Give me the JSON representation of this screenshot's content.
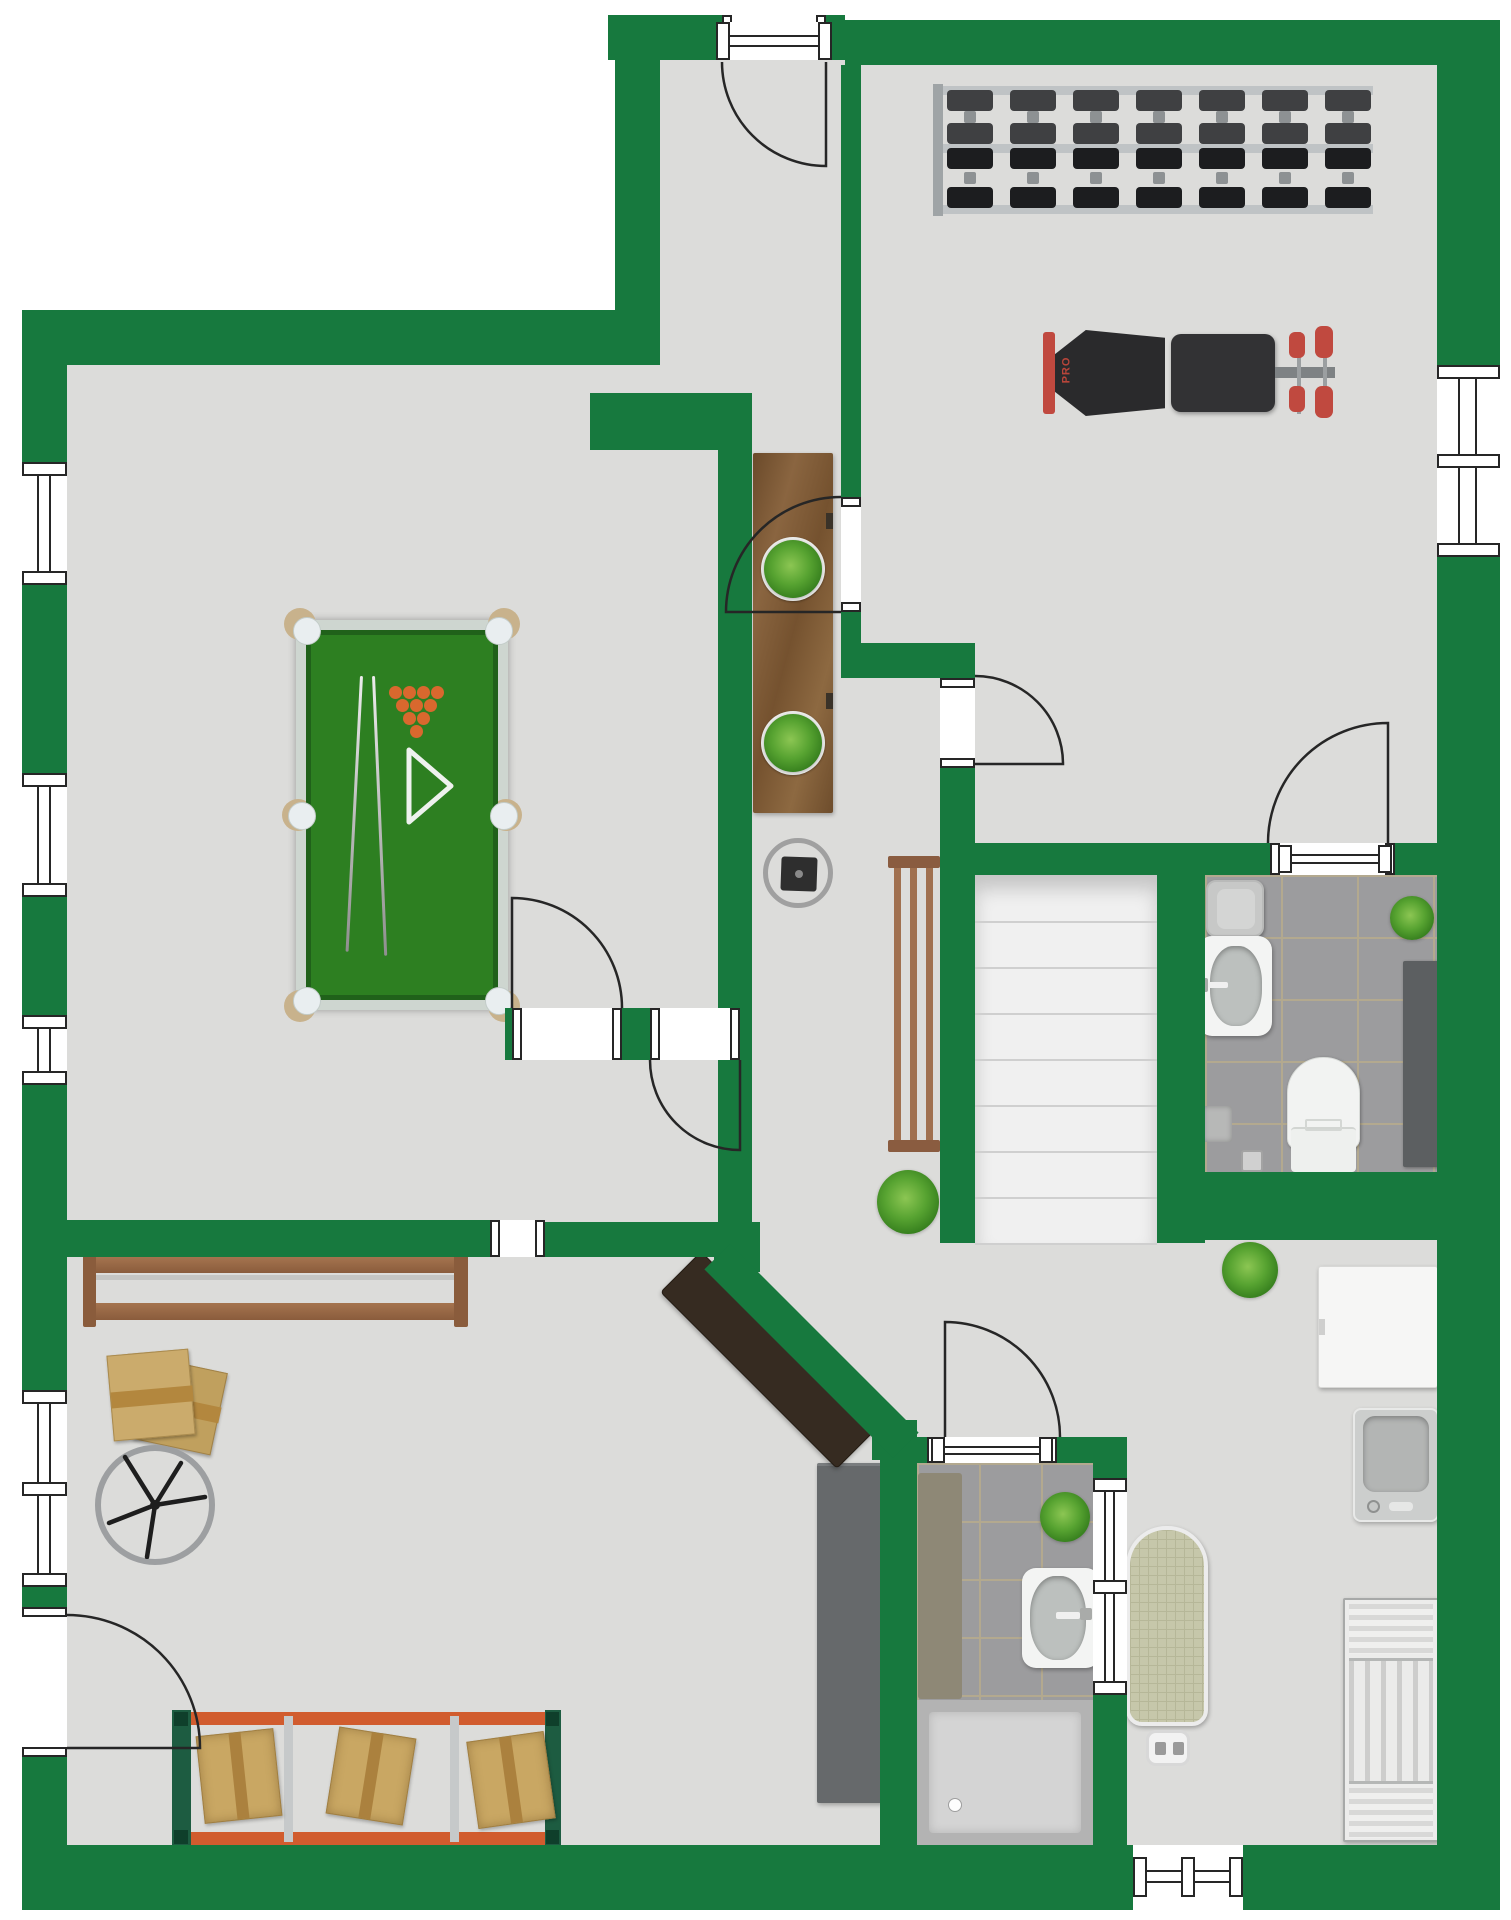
{
  "labels": {
    "bench_brand": "PRO"
  },
  "colors": {
    "wall": "#17793e",
    "floor": "#dcdcda",
    "line": "#262626",
    "tile": "#9c9c9e",
    "grout": "#b3a98f",
    "felt": "#2d7f21",
    "felt_border": "#20611a",
    "table_frame": "#ced6d0",
    "ball": "#d9682e",
    "wood": "#82613c",
    "bench_wood": "#9a6a4e",
    "desk": "#362b21",
    "rack_orange": "#d15c2e",
    "rack_green": "#1d5c41",
    "box": "#c9a763",
    "accent_red": "#c0493f"
  },
  "walls": [
    [
      608,
      15,
      114,
      45
    ],
    [
      826,
      15,
      19,
      45
    ],
    [
      845,
      20,
      592,
      45
    ],
    [
      1437,
      20,
      63,
      345
    ],
    [
      1437,
      557,
      63,
      1353
    ],
    [
      615,
      15,
      45,
      350
    ],
    [
      22,
      310,
      593,
      55
    ],
    [
      22,
      365,
      45,
      97
    ],
    [
      22,
      585,
      45,
      188
    ],
    [
      22,
      897,
      45,
      118
    ],
    [
      22,
      1085,
      45,
      305
    ],
    [
      22,
      1587,
      45,
      20
    ],
    [
      22,
      1757,
      45,
      88
    ],
    [
      22,
      1845,
      1111,
      65
    ],
    [
      1243,
      1845,
      257,
      65
    ],
    [
      841,
      65,
      20,
      432
    ],
    [
      841,
      612,
      20,
      31
    ],
    [
      841,
      643,
      134,
      35
    ],
    [
      940,
      768,
      35,
      475
    ],
    [
      590,
      393,
      162,
      57
    ],
    [
      718,
      450,
      34,
      772
    ],
    [
      67,
      1220,
      423,
      37
    ],
    [
      545,
      1222,
      172,
      35
    ],
    [
      505,
      1008,
      7,
      52
    ],
    [
      622,
      1008,
      28,
      52
    ],
    [
      740,
      1008,
      12,
      52
    ],
    [
      975,
      843,
      295,
      32
    ],
    [
      1395,
      843,
      42,
      32
    ],
    [
      1157,
      843,
      48,
      400
    ],
    [
      1157,
      1172,
      283,
      68
    ],
    [
      714,
      1222,
      46,
      50
    ],
    [
      872,
      1420,
      45,
      40
    ],
    [
      880,
      1437,
      37,
      408
    ],
    [
      917,
      1437,
      10,
      26
    ],
    [
      1057,
      1437,
      36,
      26
    ],
    [
      1093,
      1437,
      34,
      41
    ],
    [
      1093,
      1695,
      34,
      150
    ],
    [
      678,
      1333,
      267,
      36,
      45
    ]
  ],
  "windows": [
    {
      "x": 22,
      "y": 462,
      "w": 45,
      "h": 123,
      "o": "v",
      "mid": false
    },
    {
      "x": 22,
      "y": 773,
      "w": 45,
      "h": 124,
      "o": "v",
      "mid": false
    },
    {
      "x": 22,
      "y": 1015,
      "w": 45,
      "h": 70,
      "o": "v",
      "mid": false
    },
    {
      "x": 22,
      "y": 1390,
      "w": 45,
      "h": 197,
      "o": "v",
      "mid": true
    },
    {
      "x": 1437,
      "y": 365,
      "w": 63,
      "h": 192,
      "o": "v",
      "mid": true
    },
    {
      "x": 1093,
      "y": 1478,
      "w": 34,
      "h": 217,
      "o": "v",
      "mid": true
    },
    {
      "x": 1133,
      "y": 1857,
      "w": 110,
      "h": 40,
      "o": "h",
      "mid": true
    },
    {
      "x": 716,
      "y": 22,
      "w": 116,
      "h": 38,
      "o": "h",
      "mid": false
    },
    {
      "x": 1278,
      "y": 845,
      "w": 114,
      "h": 28,
      "o": "h",
      "mid": false
    },
    {
      "x": 931,
      "y": 1437,
      "w": 122,
      "h": 26,
      "o": "h",
      "mid": false
    }
  ],
  "door_gaps": [
    [
      722,
      15,
      104,
      45
    ],
    [
      841,
      497,
      20,
      115
    ],
    [
      940,
      678,
      35,
      90
    ],
    [
      512,
      1008,
      110,
      52
    ],
    [
      650,
      1008,
      90,
      52
    ],
    [
      22,
      1607,
      45,
      150
    ],
    [
      1270,
      843,
      125,
      32
    ],
    [
      927,
      1437,
      130,
      26
    ],
    [
      490,
      1220,
      55,
      37
    ]
  ],
  "door_swings": [
    {
      "path": "M826 62 L826 166 A104 104 0 0 1 722 62"
    },
    {
      "path": "M841 612 L726 612 A115 115 0 0 1 841 497"
    },
    {
      "path": "M975 764 L1063 764 A88 88 0 0 0 975 676"
    },
    {
      "path": "M512 1008 L512 898 A110 110 0 0 1 622 1008"
    },
    {
      "path": "M740 1060 L740 1150 A90 90 0 0 1 650 1060"
    },
    {
      "path": "M67 1748 L200 1748 A133 133 0 0 0 67 1615"
    },
    {
      "path": "M1388 843 L1388 723 A120 120 0 0 0 1268 843"
    },
    {
      "path": "M945 1437 L945 1322 A115 115 0 0 1 1060 1437"
    }
  ],
  "stairs": {
    "steps": 8,
    "step_px": 46
  },
  "dumbbell_rack": {
    "rows": [
      {
        "color": "#3f4042",
        "h": 54
      },
      {
        "color": "#1c1d1f",
        "h": 60
      }
    ],
    "per_row": 7
  },
  "pool_balls": {
    "rows": [
      4,
      3,
      2,
      1
    ],
    "x0": 93,
    "y0": 66,
    "dx": 14,
    "dy": 13,
    "r": 6.5
  }
}
